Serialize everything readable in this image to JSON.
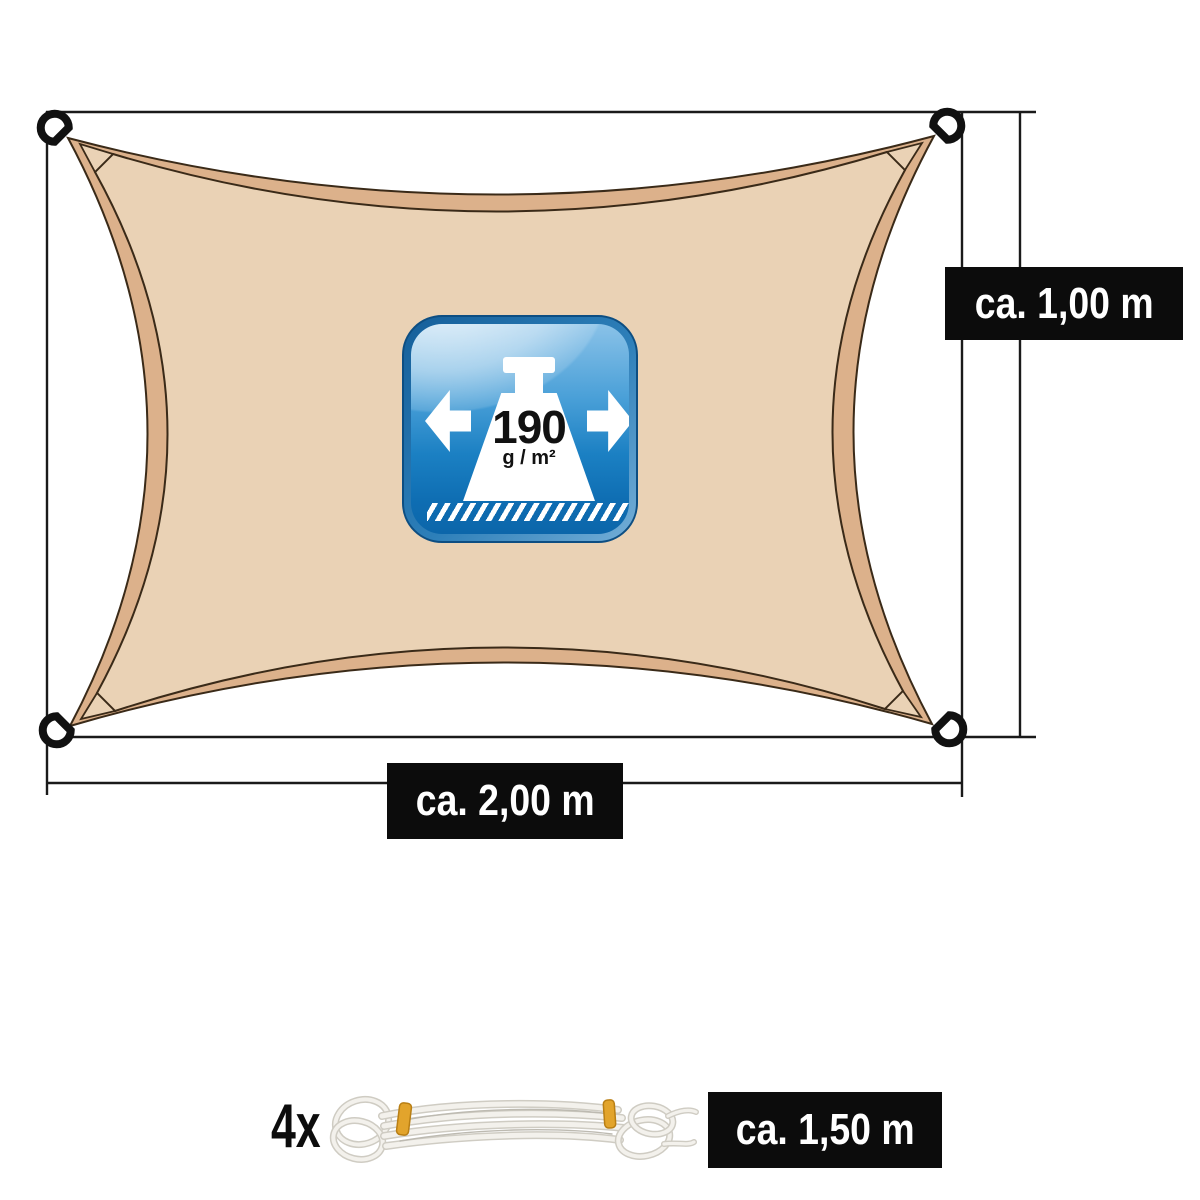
{
  "sail": {
    "description": "rectangular sun shade sail, beige, concave edges, d-ring at each corner",
    "fill_color": "#ead2b5",
    "border_strip_color": "#dcb18b",
    "outline_color": "#3a2a18",
    "ring_color": "#111111"
  },
  "dimension_labels": {
    "height": "ca. 1,00 m",
    "width": "ca. 2,00 m"
  },
  "weight_badge": {
    "value": "190",
    "unit": "g / m²",
    "base_color": "#0e6db2",
    "border_color": "#0d4e82",
    "icon": "weight-icon with left/right arrows over hatched ground line"
  },
  "rope": {
    "count": "4x",
    "length_label": "ca. 1,50 m",
    "strand_color": "#efede7",
    "band_color": "#e2a42c"
  },
  "label_style": {
    "background": "#0c0c0c",
    "text_color": "#ffffff"
  },
  "line_color": "#1a1a1a"
}
